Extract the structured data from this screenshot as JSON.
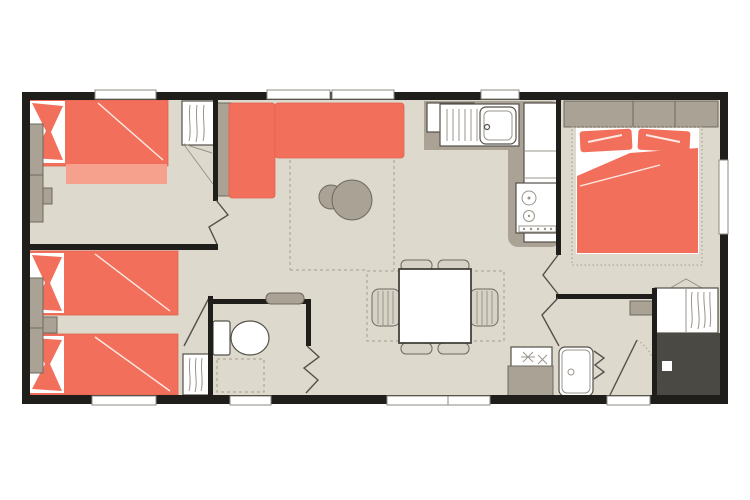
{
  "colors": {
    "wall": "#201e1a",
    "floor": "#ddd9cc",
    "accent": "#f2705b",
    "accent-light": "#f5a18e",
    "accent-edge": "#e0624d",
    "furniture": "#a9a295",
    "furniture-edge": "#6e695f",
    "chair": "#d6d2c5",
    "charcoal": "#4a4943",
    "outline": "#55514a",
    "window-stroke": "#8f8b81",
    "dashed": "#a59d8b",
    "detail": "#9a958a"
  },
  "plan": {
    "type": "floorplan",
    "rooms": [
      {
        "id": "bedroom-1",
        "fixtures": [
          "single-bed",
          "pillow",
          "wardrobe",
          "hanging-wardrobe",
          "folding-door"
        ]
      },
      {
        "id": "living-area",
        "fixtures": [
          "corner-sofa",
          "side-unit",
          "coffee-table",
          "coffee-table"
        ]
      },
      {
        "id": "kitchen",
        "fixtures": [
          "worktop",
          "cupboard",
          "sink",
          "drainer",
          "hob",
          "appliance-column",
          "ceiling-light"
        ]
      },
      {
        "id": "master-bedroom",
        "fixtures": [
          "double-bed",
          "pillow",
          "pillow",
          "headboard-cabinet",
          "wardrobe",
          "window",
          "folding-door"
        ]
      },
      {
        "id": "bedroom-2",
        "fixtures": [
          "single-bed",
          "single-bed",
          "pillow",
          "pillow",
          "nightstand",
          "wardrobe",
          "hanging-wardrobe",
          "door"
        ]
      },
      {
        "id": "wc",
        "fixtures": [
          "toilet",
          "shelf",
          "folding-door",
          "window"
        ]
      },
      {
        "id": "dining-area",
        "fixtures": [
          "table",
          "chair",
          "chair",
          "chair",
          "chair",
          "chair",
          "chair"
        ]
      },
      {
        "id": "shower-room",
        "fixtures": [
          "shower",
          "vanity-unit",
          "folding-door"
        ]
      },
      {
        "id": "entrance",
        "fixtures": [
          "entrance-door",
          "technical-locker"
        ]
      }
    ]
  }
}
